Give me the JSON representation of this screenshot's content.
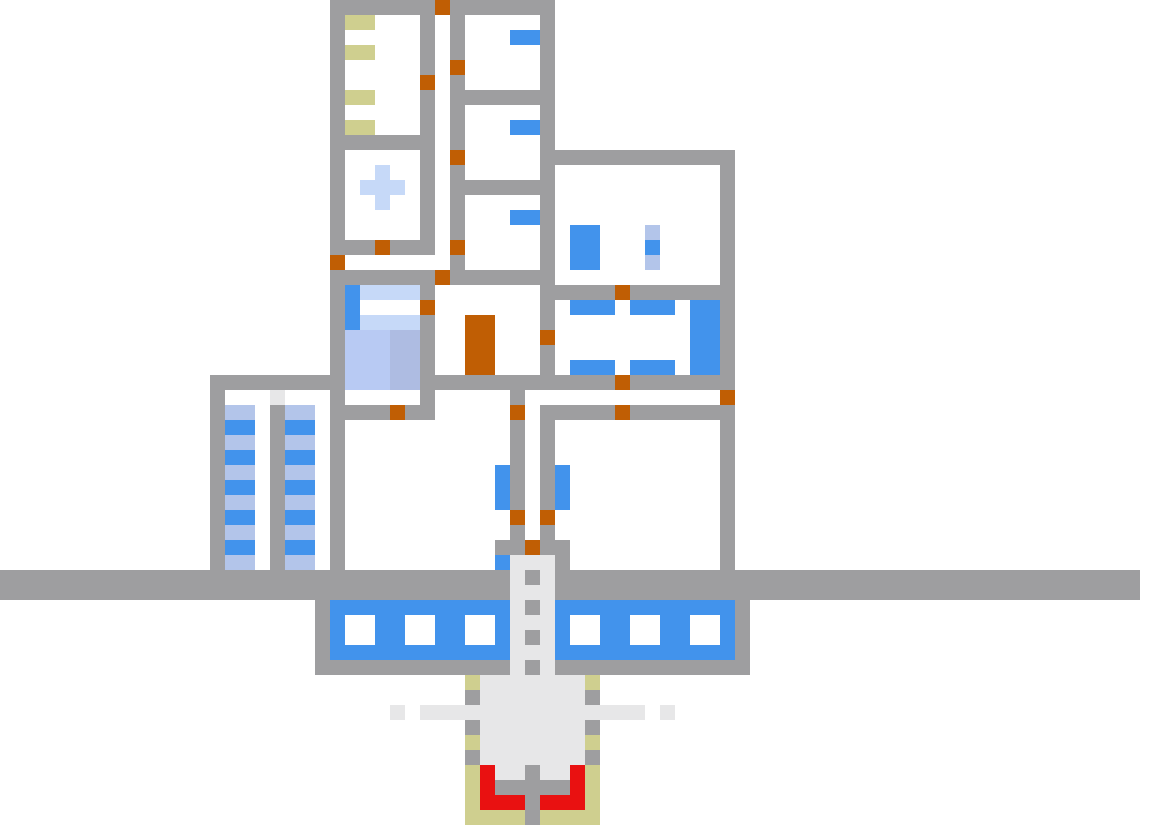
{
  "meta": {
    "title": "pixel-art base cross-section map",
    "canvas_width": 1156,
    "canvas_height": 826,
    "cell_size": 15,
    "grid_cols": 77,
    "grid_rows": 55,
    "background": "#ffffff"
  },
  "palette": {
    "G": {
      "hex": "#9e9ea0",
      "role": "wall-segment",
      "interactable": false
    },
    "O": {
      "hex": "#c05e04",
      "role": "door",
      "interactable": true
    },
    "B": {
      "hex": "#4293ec",
      "role": "blue-furniture",
      "interactable": true
    },
    "L": {
      "hex": "#b3c5ea",
      "role": "light-blue-stripe",
      "interactable": false
    },
    "P": {
      "hex": "#c6d9f8",
      "role": "pale-blue-object",
      "interactable": false
    },
    "M": {
      "hex": "#b8caf3",
      "role": "bed-blanket-light",
      "interactable": true
    },
    "N": {
      "hex": "#aebce2",
      "role": "bed-blanket-dark",
      "interactable": true
    },
    "K": {
      "hex": "#cfcf8f",
      "role": "khaki-object",
      "interactable": false
    },
    "E": {
      "hex": "#e7e7e8",
      "role": "pale-gray-structure",
      "interactable": false
    },
    "R": {
      "hex": "#e91111",
      "role": "red-furnace-intake",
      "interactable": false
    }
  },
  "landmarks": [
    "bunk-room-top-left-with-khaki-shelves",
    "medical-room-with-pale-blue-cross",
    "vertical-corridor-with-doors",
    "three-small-rooms-with-blue-wall-slots",
    "large-upper-right-room-with-blue-locker-and-ladder",
    "dining-room-with-two-blue-tables-and-blue-cabinet",
    "bedroom-with-blue-bed-and-pillow",
    "tall-orange-double-door-object",
    "left-storage-towers-with-blue-striped-crates",
    "large-left-hall",
    "large-right-hall",
    "central-shaft-with-dotted-elevator-track",
    "full-width-ground-band",
    "underground-tank-with-six-white-portholes",
    "drill-furnace-with-red-intake-khaki-housing"
  ],
  "grid": [
    "......................GGGGGGGOGGGGGGG........................................",
    "......................GKK...G.G.....G........................................",
    "......................G.....G.G...BBG........................................",
    "......................GKK...G.G.....G........................................",
    "......................G.....G.O.....G........................................",
    "......................G.....O.G.....G........................................",
    "......................GKK...G.GGGGGGG........................................",
    "......................G.....G.G.....G........................................",
    "......................GKK...G.G...BBG........................................",
    "......................GGGGGGG.G.....G........................................",
    "......................G.....G.O.....GGGGGGGGGGGGG............................",
    "......................G..P..G.G.....G...........G............................",
    "......................G.PPP.G.GGGGGGG...........G............................",
    "......................G..P..G.G.....G...........G............................",
    "......................G.....G.G...BBG...........G............................",
    "......................G.....G.G.....G.BB...L....G............................",
    "......................GGGOGGG.O.....G.BB...B....G............................",
    "......................O.......G.....G.BB...L....G............................",
    "......................GGGGGGGOGGGGGGG...........G............................",
    "......................GBPPPPG.......GGGGGOGGGGGGG............................",
    "......................GB....O.......G.BBB.BBB.BBG............................",
    "......................GBPPPPG..OO...G.........BBG............................",
    "......................GMMMNNG..OO...O.........BBG............................",
    "......................GMMMNNG..OO...G.........BBG............................",
    "......................GMMMNNG..OO...G.BBB.BBB.BBG............................",
    "..............GGGGGGGGGMMMNNGGGGGGGGGGGGGOGGGGGGG............................",
    "..............G...E...G.....G.....G.............O............................",
    "..............GLL.GLL.GGGGOGG.....O.GGGGGOGGGGGGG............................",
    "..............GBB.GBB.G...........G.G...........G............................",
    "..............GLL.GLL.G...........G.G...........G............................",
    "..............GBB.GBB.G...........G.G...........G............................",
    "..............GLL.GLL.G..........BG.GB..........G............................",
    "..............GBB.GBB.G..........BG.GB..........G............................",
    "..............GLL.GLL.G..........BG.GB..........G............................",
    "..............GBB.GBB.G...........O.O...........G............................",
    "..............GLL.GLL.G...........G.G...........G............................",
    "..............GBB.GBB.G..........GGOGG..........G............................",
    "..............GLL.GLL.G..........BEEEG..........G............................",
    "GGGGGGGGGGGGGGGGGGGGGGGGGGGGGGGGGGEGEGGGGGGGGGGGGGGGGGGGGGGGGGGGGGGGGGGGGGGG",
    "GGGGGGGGGGGGGGGGGGGGGGGGGGGGGGGGGGEEEGGGGGGGGGGGGGGGGGGGGGGGGGGGGGGGGGGGGGGG",
    ".....................GBBBBBBBBBBBBEGEBBBBBBBBBBBBG...........................",
    ".....................GB..BB..BB..BEEEB..BB..BB..BG...........................",
    ".....................GB..BB..BB..BEGEB..BB..BB..BG...........................",
    ".....................GBBBBBBBBBBBBEEEBBBBBBBBBBBBG...........................",
    ".....................GGGGGGGGGGGGGEGEGGGGGGGGGGGGG...........................",
    "...............................KEEEEEEEK.....................................",
    "...............................GEEEEEEEG.....................................",
    "..........................E.EEEEEEEEEEEEEEE.E................................",
    "...............................GEEEEEEEG.....................................",
    "...............................KEEEEEEEK.....................................",
    "...............................GEEEEEEEG.....................................",
    "...............................KREEGEERK.....................................",
    "...............................KRGGGGGRK.....................................",
    "...............................KRRRGRRRK.....................................",
    "...............................KKKKGKKKK....................................."
  ]
}
